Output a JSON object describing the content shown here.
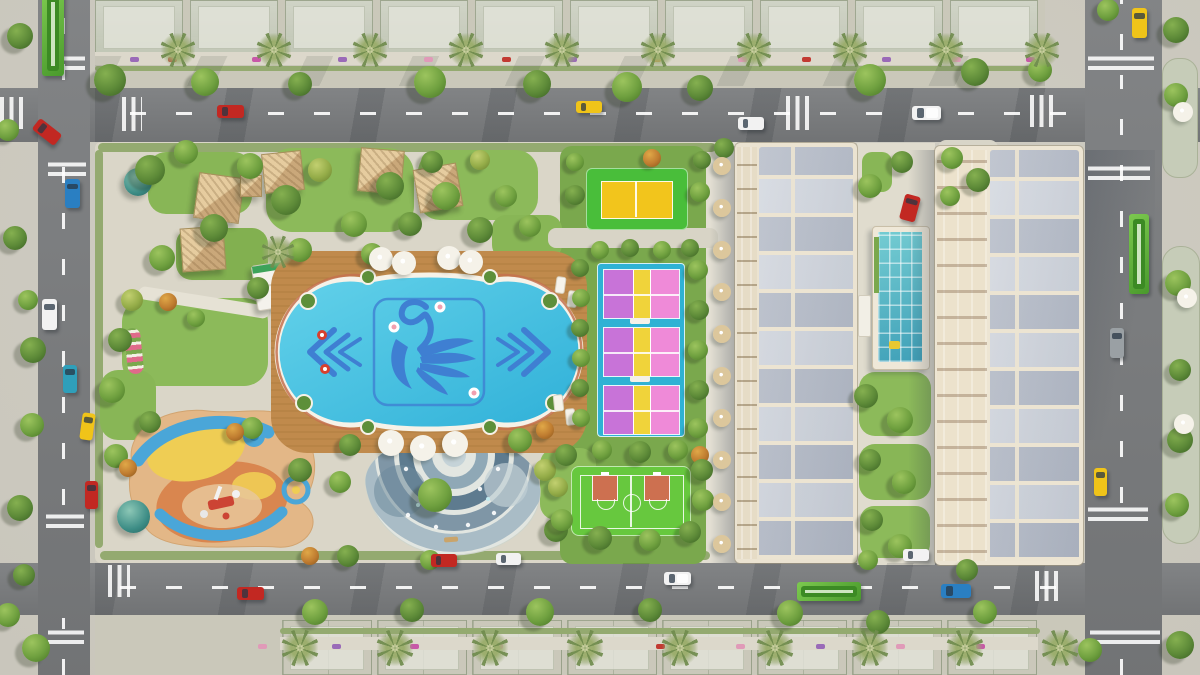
{
  "scene": {
    "kind": "aerial-3d-render-residential-masterplan",
    "palette": {
      "asphalt": "#7b7d7f",
      "sidewalk": "#cfccc1",
      "parkPaving": "#dad6c8",
      "walkPaving": "#e3dfd3",
      "lawn": "#8cba5a",
      "lawnDark": "#7aa84d",
      "hedge": "#94aa70",
      "deckWood": "#c08a4c",
      "poolWater": "#4cc4e4",
      "poolMotif": "#3f7fd2",
      "poolRim": "#f6f2e8",
      "poolCoral": "#c4714e",
      "courtCyan": "#2fb2d4",
      "courtPinkL": "#c873d8",
      "courtPinkR": "#ef8ad8",
      "courtYellowStripe": "#f0d33a",
      "badmintonGreen": "#49be3a",
      "badmintonYellow": "#f2c51c",
      "basketballGreen": "#67c83e",
      "basketballKey": "#cd7050",
      "cream": "#ebe3d1",
      "roofGray": "#c4cad4",
      "glassPool": "#57bfca",
      "domeTeal": "#3c8c85",
      "busGreen": "#5bb23a",
      "taxi": "#f0c419",
      "carRed": "#c22822",
      "carBlue": "#2a7fc2",
      "carTeal": "#2f9fba",
      "carWhite": "#f2f2f2",
      "carGray": "#9aa0a4",
      "umbrellaTan": "#dcc79c",
      "umbrellaWhite": "#f5f2e9"
    },
    "park": {
      "amenities": [
        "ornamental-swimming-pool",
        "kids-splash-plaza",
        "children-playground",
        "pickleball-courts",
        "badminton-court",
        "basketball-3x3-court",
        "thatched-gazebo-huts",
        "observation-domes",
        "poolside-umbrellas",
        "lap-pool-glass-canopy"
      ]
    },
    "vehicles": [
      {
        "name": "red-car-top-road",
        "color": "carRed",
        "x": 217,
        "y": 105,
        "w": 27,
        "h": 13,
        "rot": 0,
        "kind": "car"
      },
      {
        "name": "yellow-taxi-top-road",
        "color": "taxi",
        "x": 576,
        "y": 101,
        "w": 26,
        "h": 12,
        "rot": 0,
        "kind": "car"
      },
      {
        "name": "white-car-top-road",
        "color": "carWhite",
        "x": 738,
        "y": 117,
        "w": 26,
        "h": 13,
        "rot": 0,
        "kind": "car"
      },
      {
        "name": "white-van-top-road",
        "color": "carWhite",
        "x": 912,
        "y": 106,
        "w": 29,
        "h": 14,
        "rot": 0,
        "kind": "van"
      },
      {
        "name": "yellow-taxi-ne",
        "color": "taxi",
        "x": 1132,
        "y": 8,
        "w": 15,
        "h": 30,
        "rot": 0,
        "kind": "car"
      },
      {
        "name": "green-bus-right-road",
        "color": "busGreen",
        "x": 1129,
        "y": 214,
        "w": 20,
        "h": 80,
        "rot": 0,
        "kind": "bus"
      },
      {
        "name": "gray-car-right-road",
        "color": "carGray",
        "x": 1110,
        "y": 328,
        "w": 14,
        "h": 30,
        "rot": 0,
        "kind": "car"
      },
      {
        "name": "yellow-taxi-right-road",
        "color": "taxi",
        "x": 1094,
        "y": 468,
        "w": 13,
        "h": 28,
        "rot": 0,
        "kind": "car"
      },
      {
        "name": "green-bus-left-road",
        "color": "busGreen",
        "x": 42,
        "y": -8,
        "w": 22,
        "h": 84,
        "rot": 0,
        "kind": "bus"
      },
      {
        "name": "red-car-left-turn",
        "color": "carRed",
        "x": 33,
        "y": 125,
        "w": 28,
        "h": 14,
        "rot": 38,
        "kind": "car"
      },
      {
        "name": "blue-car-left-road",
        "color": "carBlue",
        "x": 65,
        "y": 179,
        "w": 15,
        "h": 29,
        "rot": 0,
        "kind": "car"
      },
      {
        "name": "white-car-left-road",
        "color": "carWhite",
        "x": 42,
        "y": 299,
        "w": 15,
        "h": 31,
        "rot": 0,
        "kind": "car"
      },
      {
        "name": "teal-car-left-road",
        "color": "carTeal",
        "x": 63,
        "y": 365,
        "w": 14,
        "h": 28,
        "rot": 0,
        "kind": "car"
      },
      {
        "name": "yellow-car-left-road",
        "color": "taxi",
        "x": 81,
        "y": 413,
        "w": 13,
        "h": 27,
        "rot": 8,
        "kind": "car"
      },
      {
        "name": "red-car-left-road",
        "color": "carRed",
        "x": 85,
        "y": 481,
        "w": 13,
        "h": 28,
        "rot": 0,
        "kind": "car"
      },
      {
        "name": "red-car-bottom-road-1",
        "color": "carRed",
        "x": 237,
        "y": 587,
        "w": 27,
        "h": 13,
        "rot": 0,
        "kind": "car"
      },
      {
        "name": "red-car-bottom-road-2",
        "color": "carRed",
        "x": 431,
        "y": 554,
        "w": 26,
        "h": 13,
        "rot": 0,
        "kind": "car"
      },
      {
        "name": "white-car-bottom-road-1",
        "color": "carWhite",
        "x": 496,
        "y": 553,
        "w": 25,
        "h": 12,
        "rot": 0,
        "kind": "car"
      },
      {
        "name": "white-pickup-bottom-road",
        "color": "carWhite",
        "x": 664,
        "y": 572,
        "w": 27,
        "h": 13,
        "rot": 0,
        "kind": "van"
      },
      {
        "name": "green-bus-bottom-road",
        "color": "busGreen",
        "x": 797,
        "y": 582,
        "w": 64,
        "h": 19,
        "rot": 0,
        "kind": "bus"
      },
      {
        "name": "blue-car-bottom-road",
        "color": "carBlue",
        "x": 941,
        "y": 584,
        "w": 30,
        "h": 14,
        "rot": 0,
        "kind": "car"
      },
      {
        "name": "white-car-parked",
        "color": "carWhite",
        "x": 903,
        "y": 549,
        "w": 26,
        "h": 12,
        "rot": 0,
        "kind": "car"
      },
      {
        "name": "red-car-courtyard",
        "color": "carRed",
        "x": 902,
        "y": 195,
        "w": 16,
        "h": 26,
        "rot": 15,
        "kind": "car"
      }
    ],
    "trees": [
      [
        110,
        80,
        16,
        1
      ],
      [
        205,
        82,
        14,
        2
      ],
      [
        300,
        84,
        12,
        1
      ],
      [
        430,
        82,
        16,
        2
      ],
      [
        537,
        84,
        14,
        1
      ],
      [
        627,
        87,
        15,
        2
      ],
      [
        700,
        88,
        13,
        1
      ],
      [
        870,
        80,
        16,
        2
      ],
      [
        975,
        72,
        14,
        1
      ],
      [
        1040,
        70,
        12,
        2
      ],
      [
        1176,
        30,
        13,
        1
      ],
      [
        1176,
        95,
        12,
        2
      ],
      [
        1178,
        283,
        13,
        2
      ],
      [
        1180,
        370,
        11,
        1
      ],
      [
        1180,
        440,
        13,
        1
      ],
      [
        1177,
        505,
        12,
        2
      ],
      [
        1108,
        10,
        11,
        2
      ],
      [
        1180,
        645,
        14,
        1
      ],
      [
        1090,
        650,
        12,
        2
      ],
      [
        20,
        36,
        13,
        1
      ],
      [
        8,
        130,
        11,
        2
      ],
      [
        15,
        238,
        12,
        1
      ],
      [
        28,
        300,
        10,
        2
      ],
      [
        33,
        350,
        13,
        1
      ],
      [
        32,
        425,
        12,
        2
      ],
      [
        20,
        508,
        13,
        1
      ],
      [
        24,
        575,
        11,
        1
      ],
      [
        8,
        615,
        12,
        2
      ],
      [
        36,
        648,
        14,
        2
      ],
      [
        315,
        612,
        13,
        2
      ],
      [
        412,
        610,
        12,
        1
      ],
      [
        540,
        612,
        14,
        2
      ],
      [
        650,
        610,
        12,
        1
      ],
      [
        790,
        613,
        13,
        2
      ],
      [
        878,
        622,
        12,
        1
      ],
      [
        985,
        612,
        12,
        2
      ],
      [
        967,
        570,
        11,
        1
      ],
      [
        150,
        170,
        15,
        1
      ],
      [
        186,
        152,
        12,
        2
      ],
      [
        214,
        228,
        14,
        1
      ],
      [
        250,
        166,
        13,
        2
      ],
      [
        286,
        200,
        15,
        1
      ],
      [
        320,
        170,
        12,
        3
      ],
      [
        354,
        224,
        13,
        2
      ],
      [
        390,
        186,
        14,
        1
      ],
      [
        300,
        250,
        12,
        2
      ],
      [
        258,
        288,
        11,
        1
      ],
      [
        162,
        258,
        13,
        2
      ],
      [
        132,
        300,
        11,
        3
      ],
      [
        372,
        254,
        11,
        2
      ],
      [
        410,
        224,
        12,
        1
      ],
      [
        446,
        196,
        14,
        2
      ],
      [
        480,
        230,
        13,
        1
      ],
      [
        506,
        196,
        11,
        2
      ],
      [
        432,
        162,
        11,
        1
      ],
      [
        480,
        160,
        10,
        3
      ],
      [
        530,
        226,
        11,
        2
      ],
      [
        168,
        302,
        9,
        4
      ],
      [
        196,
        318,
        9,
        2
      ],
      [
        120,
        340,
        12,
        1
      ],
      [
        112,
        390,
        13,
        2
      ],
      [
        150,
        422,
        11,
        1
      ],
      [
        116,
        456,
        12,
        2
      ],
      [
        128,
        468,
        9,
        4
      ],
      [
        252,
        428,
        11,
        2
      ],
      [
        235,
        432,
        9,
        4
      ],
      [
        300,
        470,
        12,
        1
      ],
      [
        340,
        482,
        11,
        2
      ],
      [
        310,
        556,
        9,
        4
      ],
      [
        348,
        556,
        11,
        1
      ],
      [
        435,
        495,
        17,
        2
      ],
      [
        350,
        445,
        11,
        1
      ],
      [
        520,
        440,
        12,
        2
      ],
      [
        545,
        430,
        9,
        4
      ],
      [
        556,
        530,
        12,
        1
      ],
      [
        430,
        560,
        10,
        2
      ],
      [
        545,
        470,
        11,
        3
      ],
      [
        575,
        195,
        10,
        1
      ],
      [
        700,
        192,
        10,
        2
      ],
      [
        575,
        162,
        9,
        2
      ],
      [
        702,
        160,
        9,
        1
      ],
      [
        652,
        158,
        9,
        4
      ],
      [
        580,
        268,
        9,
        1
      ],
      [
        581,
        298,
        9,
        2
      ],
      [
        580,
        328,
        9,
        1
      ],
      [
        581,
        358,
        9,
        2
      ],
      [
        580,
        388,
        9,
        1
      ],
      [
        581,
        418,
        9,
        2
      ],
      [
        600,
        250,
        9,
        2
      ],
      [
        630,
        248,
        9,
        1
      ],
      [
        662,
        250,
        9,
        2
      ],
      [
        690,
        248,
        9,
        1
      ],
      [
        698,
        270,
        10,
        2
      ],
      [
        699,
        310,
        10,
        1
      ],
      [
        698,
        350,
        10,
        2
      ],
      [
        699,
        390,
        10,
        1
      ],
      [
        698,
        428,
        10,
        2
      ],
      [
        700,
        455,
        9,
        4
      ],
      [
        566,
        455,
        11,
        1
      ],
      [
        602,
        450,
        10,
        2
      ],
      [
        640,
        452,
        11,
        1
      ],
      [
        678,
        450,
        10,
        2
      ],
      [
        702,
        470,
        11,
        1
      ],
      [
        703,
        500,
        11,
        2
      ],
      [
        562,
        520,
        11,
        2
      ],
      [
        600,
        538,
        12,
        1
      ],
      [
        650,
        540,
        11,
        2
      ],
      [
        690,
        532,
        11,
        1
      ],
      [
        558,
        487,
        10,
        3
      ],
      [
        866,
        396,
        12,
        1
      ],
      [
        900,
        420,
        13,
        2
      ],
      [
        870,
        460,
        11,
        1
      ],
      [
        904,
        482,
        12,
        2
      ],
      [
        872,
        520,
        11,
        1
      ],
      [
        900,
        546,
        12,
        2
      ],
      [
        870,
        186,
        12,
        2
      ],
      [
        902,
        162,
        11,
        1
      ],
      [
        868,
        560,
        10,
        2
      ],
      [
        952,
        158,
        11,
        2
      ],
      [
        978,
        180,
        12,
        1
      ],
      [
        950,
        196,
        10,
        2
      ],
      [
        724,
        148,
        10,
        1
      ]
    ],
    "palms": {
      "top": {
        "y": 50,
        "xs": [
          178,
          274,
          370,
          466,
          562,
          658,
          754,
          850,
          946,
          1042
        ]
      },
      "bottom": {
        "y": 648,
        "xs": [
          300,
          395,
          490,
          585,
          680,
          775,
          870,
          965,
          1060
        ]
      },
      "extra": [
        [
          278,
          252
        ]
      ]
    },
    "mini_cars": {
      "colors": {
        "p": "#9a6ab8",
        "k": "#e09ab8",
        "m": "#c858a8",
        "r": "#c23a32",
        "o": "#d8893a",
        "t": "#4aa2a8"
      },
      "rows": [
        {
          "y": 57,
          "xs": [
            [
              130,
              "p"
            ],
            [
              168,
              "r"
            ],
            [
              252,
              "m"
            ],
            [
              338,
              "p"
            ],
            [
              424,
              "k"
            ],
            [
              502,
              "r"
            ],
            [
              568,
              "p"
            ],
            [
              652,
              "o"
            ],
            [
              738,
              "k"
            ],
            [
              802,
              "r"
            ],
            [
              882,
              "p"
            ],
            [
              952,
              "k"
            ],
            [
              1026,
              "m"
            ]
          ]
        },
        {
          "y": 644,
          "xs": [
            [
              258,
              "k"
            ],
            [
              332,
              "p"
            ],
            [
              410,
              "m"
            ],
            [
              494,
              "k"
            ],
            [
              576,
              "p"
            ],
            [
              656,
              "r"
            ],
            [
              736,
              "k"
            ],
            [
              816,
              "p"
            ],
            [
              896,
              "k"
            ],
            [
              976,
              "m"
            ],
            [
              1056,
              "k"
            ]
          ]
        }
      ]
    },
    "crosswalks": [
      [
        55,
        54,
        30,
        16,
        "h"
      ],
      [
        0,
        97,
        26,
        32,
        "v"
      ],
      [
        48,
        160,
        38,
        16,
        "h"
      ],
      [
        122,
        97,
        20,
        34,
        "v"
      ],
      [
        786,
        96,
        24,
        34,
        "v"
      ],
      [
        1030,
        95,
        25,
        32,
        "v"
      ],
      [
        1088,
        52,
        66,
        18,
        "h"
      ],
      [
        1088,
        162,
        62,
        18,
        "h"
      ],
      [
        46,
        512,
        38,
        16,
        "h"
      ],
      [
        48,
        628,
        36,
        16,
        "h"
      ],
      [
        108,
        565,
        22,
        32,
        "v"
      ],
      [
        1035,
        571,
        24,
        30,
        "v"
      ],
      [
        1088,
        506,
        60,
        15,
        "h"
      ],
      [
        1090,
        628,
        70,
        16,
        "h"
      ]
    ],
    "ghost_blocks": {
      "top": {
        "y": 0,
        "h": 54,
        "w": 88,
        "xs": [
          95,
          190,
          285,
          380,
          475,
          570,
          665,
          760,
          855,
          950
        ]
      },
      "bottom": {
        "y": 620,
        "h": 55,
        "w": 90,
        "xs": [
          282,
          377,
          472,
          567,
          662,
          757,
          852,
          947
        ]
      }
    },
    "umbrellas": {
      "tan": [
        [
          722,
          166
        ],
        [
          722,
          208
        ],
        [
          722,
          250
        ],
        [
          722,
          292
        ],
        [
          722,
          334
        ],
        [
          722,
          376
        ],
        [
          722,
          418
        ],
        [
          722,
          460
        ],
        [
          722,
          502
        ],
        [
          722,
          544
        ]
      ],
      "white": [
        [
          381,
          259,
          12
        ],
        [
          404,
          263,
          12
        ],
        [
          449,
          258,
          12
        ],
        [
          471,
          262,
          12
        ],
        [
          391,
          443,
          13
        ],
        [
          423,
          448,
          13
        ],
        [
          455,
          444,
          13
        ],
        [
          1183,
          112,
          10
        ],
        [
          1187,
          298,
          10
        ],
        [
          1184,
          424,
          10
        ]
      ]
    }
  }
}
